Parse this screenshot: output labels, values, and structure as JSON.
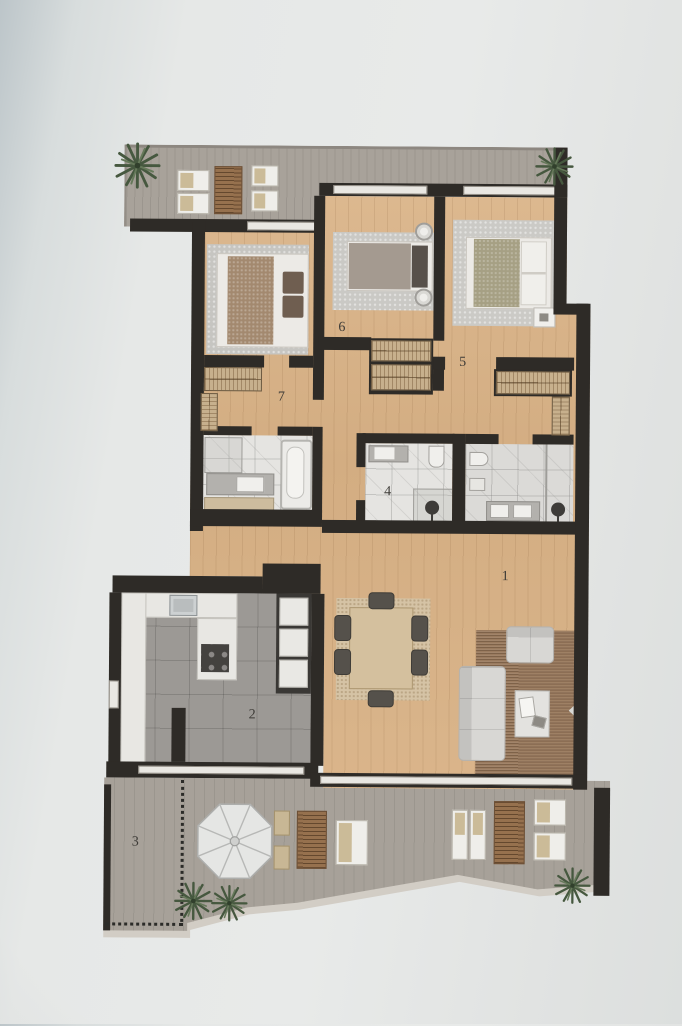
{
  "document": {
    "kind": "apartment floor plan (photographed)"
  },
  "room_labels": {
    "living": "1",
    "kitchen": "2",
    "terrace": "3",
    "bathroom": "4",
    "bedroom_right": "5",
    "bedroom_middle": "6",
    "dressing": "7"
  },
  "palette": {
    "wall": "#2e2b27",
    "wood_floor": "#d7b288",
    "kitchen_tile": "#9c9995",
    "terrace_gray": "#a7a199",
    "balcony_gray": "#a8a29a",
    "marble": "#e5e4e1",
    "paper": "#e6e8e7",
    "rug_brown": "#9a7b5f",
    "wardrobe_tan": "#c7b08d",
    "plant_green": "#46583f"
  },
  "icons": {
    "plant": "palm-plant",
    "umbrella": "parasol",
    "shower": "shower-head"
  }
}
